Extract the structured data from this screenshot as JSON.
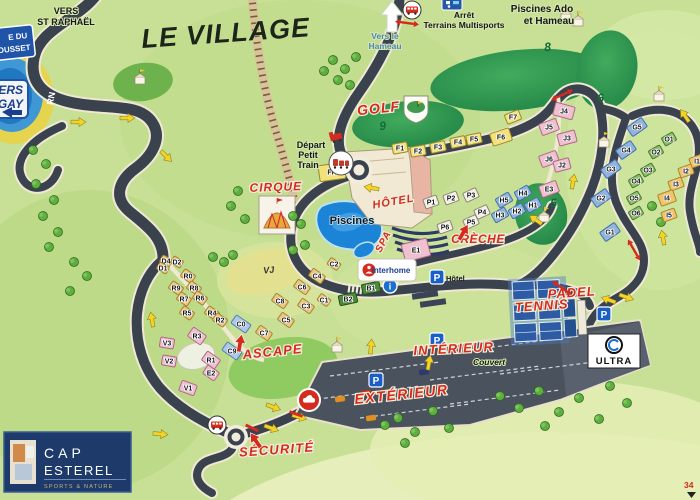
{
  "map_title": "LE VILLAGE",
  "signs": {
    "top_left_blue": {
      "line1": "E DU",
      "line2": "ROUSSET"
    },
    "vers_agay": {
      "line1": "ERS",
      "line2": "GAY"
    },
    "vers_st_raphael": {
      "line1": "VERS",
      "line2": "ST RAPHAËL"
    },
    "rn": "RN",
    "vers_le_hameau": {
      "line1": "Vers le",
      "line2": "Hameau"
    },
    "arret_multisports": {
      "line1": "Arrêt",
      "line2": "Terrains Multisports"
    },
    "piscines_ado": {
      "line1": "Piscines Ado",
      "line2": "et Hameau"
    },
    "depart_petit_train": {
      "line1": "Départ",
      "line2": "Petit",
      "line3": "Train"
    }
  },
  "labels": {
    "piscines": "Piscines",
    "hotel_parking": "Hôtel",
    "couvert": "Couvert",
    "vj": "VJ",
    "interhome": "interhome",
    "ultra": "ULTRA",
    "parking_p": "P",
    "info_i": "i",
    "corner_number": "34"
  },
  "logo": {
    "line1": "CAP",
    "line2": "ESTEREL",
    "tagline": "SPORTS & NATURE"
  },
  "zones": [
    {
      "text": "GOLF",
      "x": 379,
      "y": 113,
      "s": 14,
      "r": -6,
      "ls": 1
    },
    {
      "text": "CIRQUE",
      "x": 276,
      "y": 191,
      "s": 12,
      "r": -2,
      "ls": 1
    },
    {
      "text": "HÔTEL",
      "x": 394,
      "y": 205,
      "s": 11,
      "r": -10,
      "ls": 1
    },
    {
      "text": "SPA",
      "x": 386,
      "y": 243,
      "s": 10,
      "r": -62,
      "ls": 1
    },
    {
      "text": "CRÈCHE",
      "x": 478,
      "y": 243,
      "s": 12,
      "r": 0,
      "ls": 0.5
    },
    {
      "text": "PADEL",
      "x": 572,
      "y": 297,
      "s": 13,
      "r": -4,
      "ls": 1
    },
    {
      "text": "TENNIS",
      "x": 542,
      "y": 310,
      "s": 13,
      "r": -4,
      "ls": 1
    },
    {
      "text": "ASCAPE",
      "x": 273,
      "y": 356,
      "s": 13,
      "r": -6,
      "ls": 1
    },
    {
      "text": "INTÉRIEUR",
      "x": 454,
      "y": 353,
      "s": 13,
      "r": -3,
      "ls": 1.2
    },
    {
      "text": "EXTÉRIEUR",
      "x": 402,
      "y": 399,
      "s": 14,
      "r": -6,
      "ls": 1.6
    },
    {
      "text": "SÉCURITÉ",
      "x": 277,
      "y": 454,
      "s": 13,
      "r": -4,
      "ls": 1.2
    }
  ],
  "golf_holes": [
    {
      "n": "8",
      "x": 548,
      "y": 51
    },
    {
      "n": "9",
      "x": 383,
      "y": 130
    },
    {
      "n": "6",
      "x": 601,
      "y": 102
    },
    {
      "n": "5",
      "x": 554,
      "y": 207
    }
  ],
  "buildings": [
    {
      "l": "F1",
      "x": 400,
      "y": 148,
      "c": "yellow",
      "r": -10
    },
    {
      "l": "F2",
      "x": 418,
      "y": 151,
      "c": "yellow",
      "r": -10
    },
    {
      "l": "F3",
      "x": 438,
      "y": 147,
      "c": "yellow",
      "r": -12
    },
    {
      "l": "F4",
      "x": 458,
      "y": 142,
      "c": "yellow",
      "r": -12
    },
    {
      "l": "F5",
      "x": 474,
      "y": 139,
      "c": "yellow",
      "r": -12
    },
    {
      "l": "F6",
      "x": 501,
      "y": 137,
      "c": "yellow",
      "r": -18,
      "w": 20,
      "h": 13
    },
    {
      "l": "F7",
      "x": 513,
      "y": 117,
      "c": "yellow",
      "r": -22
    },
    {
      "l": "FH",
      "x": 332,
      "y": 172,
      "c": "yellow",
      "r": -8,
      "w": 26,
      "h": 16
    },
    {
      "l": "J4",
      "x": 564,
      "y": 111,
      "c": "pink",
      "r": 15,
      "w": 20,
      "h": 13
    },
    {
      "l": "J5",
      "x": 549,
      "y": 127,
      "c": "pink",
      "r": -20,
      "w": 18,
      "h": 12
    },
    {
      "l": "J3",
      "x": 567,
      "y": 138,
      "c": "pink",
      "r": -15,
      "w": 18,
      "h": 12
    },
    {
      "l": "J6",
      "x": 549,
      "y": 159,
      "c": "pink",
      "r": -20,
      "w": 18,
      "h": 12
    },
    {
      "l": "J2",
      "x": 562,
      "y": 165,
      "c": "pink",
      "r": -15,
      "w": 16,
      "h": 11
    },
    {
      "l": "E3",
      "x": 549,
      "y": 189,
      "c": "pink",
      "r": -20,
      "w": 18,
      "h": 12
    },
    {
      "l": "E1",
      "x": 416,
      "y": 250,
      "c": "pink",
      "r": -15,
      "w": 26,
      "h": 18
    },
    {
      "l": "G5",
      "x": 637,
      "y": 127,
      "c": "blue",
      "r": -35,
      "w": 18,
      "h": 11
    },
    {
      "l": "G4",
      "x": 626,
      "y": 150,
      "c": "blue",
      "r": -35,
      "w": 18,
      "h": 11
    },
    {
      "l": "G3",
      "x": 611,
      "y": 169,
      "c": "blue",
      "r": -35,
      "w": 18,
      "h": 11
    },
    {
      "l": "G2",
      "x": 601,
      "y": 198,
      "c": "blue",
      "r": -35,
      "w": 18,
      "h": 11
    },
    {
      "l": "G1",
      "x": 610,
      "y": 232,
      "c": "blue",
      "r": -35,
      "w": 18,
      "h": 11
    },
    {
      "l": "O1",
      "x": 669,
      "y": 139,
      "c": "green",
      "r": -30,
      "w": 13,
      "h": 9
    },
    {
      "l": "O2",
      "x": 656,
      "y": 152,
      "c": "green",
      "r": -30,
      "w": 13,
      "h": 9
    },
    {
      "l": "O3",
      "x": 648,
      "y": 170,
      "c": "green",
      "r": -30,
      "w": 13,
      "h": 9
    },
    {
      "l": "O4",
      "x": 636,
      "y": 181,
      "c": "green",
      "r": -30,
      "w": 13,
      "h": 9
    },
    {
      "l": "O5",
      "x": 634,
      "y": 198,
      "c": "green",
      "r": -30,
      "w": 13,
      "h": 9
    },
    {
      "l": "O6",
      "x": 636,
      "y": 213,
      "c": "green",
      "r": -30,
      "w": 13,
      "h": 9
    },
    {
      "l": "I1",
      "x": 697,
      "y": 161,
      "c": "orange",
      "r": -20,
      "w": 14,
      "h": 10
    },
    {
      "l": "I2",
      "x": 686,
      "y": 171,
      "c": "orange",
      "r": -20,
      "w": 14,
      "h": 10
    },
    {
      "l": "I3",
      "x": 676,
      "y": 184,
      "c": "orange",
      "r": -20,
      "w": 14,
      "h": 10
    },
    {
      "l": "I4",
      "x": 667,
      "y": 198,
      "c": "orange",
      "r": -20,
      "w": 16,
      "h": 12
    },
    {
      "l": "I5",
      "x": 669,
      "y": 215,
      "c": "orange",
      "r": -20,
      "w": 14,
      "h": 10
    },
    {
      "l": "H5",
      "x": 504,
      "y": 200,
      "c": "blue",
      "r": -30,
      "w": 15,
      "h": 10
    },
    {
      "l": "H4",
      "x": 523,
      "y": 193,
      "c": "blue",
      "r": -30,
      "w": 15,
      "h": 10
    },
    {
      "l": "H3",
      "x": 500,
      "y": 215,
      "c": "blue",
      "r": -30,
      "w": 15,
      "h": 10
    },
    {
      "l": "H2",
      "x": 517,
      "y": 211,
      "c": "blue",
      "r": -30,
      "w": 15,
      "h": 10
    },
    {
      "l": "H1",
      "x": 533,
      "y": 205,
      "c": "blue",
      "r": -30,
      "w": 15,
      "h": 10
    },
    {
      "l": "P1",
      "x": 431,
      "y": 202,
      "c": "white",
      "r": -20,
      "w": 14,
      "h": 10
    },
    {
      "l": "P2",
      "x": 451,
      "y": 198,
      "c": "white",
      "r": -20,
      "w": 14,
      "h": 10
    },
    {
      "l": "P3",
      "x": 471,
      "y": 195,
      "c": "white",
      "r": -25,
      "w": 14,
      "h": 10
    },
    {
      "l": "P4",
      "x": 482,
      "y": 212,
      "c": "white",
      "r": -25,
      "w": 14,
      "h": 10
    },
    {
      "l": "P5",
      "x": 471,
      "y": 222,
      "c": "white",
      "r": -25,
      "w": 14,
      "h": 10
    },
    {
      "l": "P6",
      "x": 445,
      "y": 227,
      "c": "white",
      "r": -20,
      "w": 14,
      "h": 10
    },
    {
      "l": "R0",
      "x": 188,
      "y": 276,
      "c": "tan",
      "r": 35,
      "w": 13,
      "h": 9
    },
    {
      "l": "R9",
      "x": 176,
      "y": 288,
      "c": "tan",
      "r": 35,
      "w": 13,
      "h": 9
    },
    {
      "l": "R8",
      "x": 194,
      "y": 288,
      "c": "tan",
      "r": 35,
      "w": 13,
      "h": 9
    },
    {
      "l": "R7",
      "x": 184,
      "y": 299,
      "c": "tan",
      "r": 35,
      "w": 13,
      "h": 9
    },
    {
      "l": "R6",
      "x": 200,
      "y": 298,
      "c": "tan",
      "r": 35,
      "w": 13,
      "h": 9
    },
    {
      "l": "R5",
      "x": 187,
      "y": 313,
      "c": "tan",
      "r": 35,
      "w": 13,
      "h": 9
    },
    {
      "l": "R4",
      "x": 212,
      "y": 313,
      "c": "tan",
      "r": 35,
      "w": 13,
      "h": 9
    },
    {
      "l": "R2",
      "x": 220,
      "y": 320,
      "c": "tan",
      "r": 35,
      "w": 13,
      "h": 9
    },
    {
      "l": "D4",
      "x": 166,
      "y": 261,
      "c": "tan",
      "r": 30,
      "w": 11,
      "h": 8
    },
    {
      "l": "D2",
      "x": 177,
      "y": 262,
      "c": "tan",
      "r": 30,
      "w": 11,
      "h": 8
    },
    {
      "l": "D1",
      "x": 163,
      "y": 268,
      "c": "tan",
      "r": 30,
      "w": 11,
      "h": 8
    },
    {
      "l": "R3",
      "x": 197,
      "y": 336,
      "c": "pink",
      "r": 35,
      "w": 16,
      "h": 11
    },
    {
      "l": "R1",
      "x": 211,
      "y": 360,
      "c": "pink",
      "r": 35,
      "w": 16,
      "h": 11
    },
    {
      "l": "E2",
      "x": 211,
      "y": 373,
      "c": "pink",
      "r": 35,
      "w": 14,
      "h": 10
    },
    {
      "l": "V1",
      "x": 188,
      "y": 388,
      "c": "pink",
      "r": 20,
      "w": 16,
      "h": 11
    },
    {
      "l": "V2",
      "x": 169,
      "y": 361,
      "c": "pink",
      "r": 10,
      "w": 14,
      "h": 10
    },
    {
      "l": "V3",
      "x": 167,
      "y": 343,
      "c": "pink",
      "r": 10,
      "w": 14,
      "h": 10
    },
    {
      "l": "C4",
      "x": 317,
      "y": 276,
      "c": "tan",
      "r": 35,
      "w": 15,
      "h": 9
    },
    {
      "l": "C6",
      "x": 302,
      "y": 287,
      "c": "tan",
      "r": 35,
      "w": 15,
      "h": 9
    },
    {
      "l": "C8",
      "x": 280,
      "y": 301,
      "c": "tan",
      "r": 35,
      "w": 15,
      "h": 9
    },
    {
      "l": "C3",
      "x": 306,
      "y": 306,
      "c": "tan",
      "r": 35,
      "w": 15,
      "h": 9
    },
    {
      "l": "C5",
      "x": 286,
      "y": 320,
      "c": "tan",
      "r": 35,
      "w": 15,
      "h": 9
    },
    {
      "l": "C7",
      "x": 264,
      "y": 333,
      "c": "tan",
      "r": 35,
      "w": 15,
      "h": 9
    },
    {
      "l": "C1",
      "x": 324,
      "y": 300,
      "c": "tan",
      "r": 35,
      "w": 12,
      "h": 8
    },
    {
      "l": "C2",
      "x": 334,
      "y": 264,
      "c": "tan",
      "r": 35,
      "w": 12,
      "h": 8
    },
    {
      "l": "C0",
      "x": 241,
      "y": 324,
      "c": "lightblue",
      "r": 35,
      "w": 18,
      "h": 10
    },
    {
      "l": "C9",
      "x": 232,
      "y": 351,
      "c": "lightblue",
      "r": 35,
      "w": 18,
      "h": 10
    },
    {
      "l": "B1",
      "x": 371,
      "y": 288,
      "c": "darkgreen",
      "r": -12,
      "w": 18,
      "h": 10
    },
    {
      "l": "B2",
      "x": 348,
      "y": 299,
      "c": "darkgreen",
      "r": -12,
      "w": 18,
      "h": 10
    }
  ],
  "palette": {
    "yellow": {
      "f": "#f3e27a",
      "s": "#9a8a30"
    },
    "pink": {
      "f": "#efc0cf",
      "s": "#b06a85"
    },
    "blue": {
      "f": "#8fb4e0",
      "s": "#4a6fa8"
    },
    "green": {
      "f": "#8cc061",
      "s": "#4a7a32"
    },
    "darkgreen": {
      "f": "#4e8a3c",
      "s": "#27511d"
    },
    "orange": {
      "f": "#f0c468",
      "s": "#a8842e"
    },
    "tan": {
      "f": "#e9c77e",
      "s": "#a8842e"
    },
    "white": {
      "f": "#f4efdf",
      "s": "#8a8578"
    },
    "lightblue": {
      "f": "#aac8e8",
      "s": "#5a7fb0"
    }
  },
  "colors": {
    "red_label": "#d42b1e",
    "road": "#3a424d",
    "road_casing": "#efe8d4",
    "pool_blue": "#1b84d6",
    "golf_green_dark": "#248747",
    "parking": "#4a525e",
    "logo_navy": "#1d3a6b",
    "parking_icon_blue": "#1a5fc8"
  },
  "yellow_arrows": [
    {
      "x": 78,
      "y": 122,
      "r": 0
    },
    {
      "x": 127,
      "y": 118,
      "r": 0
    },
    {
      "x": 166,
      "y": 156,
      "r": 45
    },
    {
      "x": 152,
      "y": 320,
      "r": 260
    },
    {
      "x": 372,
      "y": 188,
      "r": 190
    },
    {
      "x": 536,
      "y": 220,
      "r": 215
    },
    {
      "x": 573,
      "y": 182,
      "r": 280
    },
    {
      "x": 685,
      "y": 116,
      "r": 235
    },
    {
      "x": 663,
      "y": 238,
      "r": 260
    },
    {
      "x": 609,
      "y": 300,
      "r": 200
    },
    {
      "x": 626,
      "y": 297,
      "r": 20
    },
    {
      "x": 371,
      "y": 347,
      "r": 275
    },
    {
      "x": 429,
      "y": 363,
      "r": 280
    },
    {
      "x": 273,
      "y": 407,
      "r": 20
    },
    {
      "x": 299,
      "y": 417,
      "r": 15
    },
    {
      "x": 271,
      "y": 428,
      "r": 20
    },
    {
      "x": 160,
      "y": 434,
      "r": 5
    }
  ],
  "red_up_arrows": [
    {
      "x": 463,
      "y": 233,
      "r": 30
    },
    {
      "x": 240,
      "y": 344,
      "r": 10
    },
    {
      "x": 256,
      "y": 441,
      "r": -35
    }
  ],
  "red_cross_arrows": [
    {
      "x": 407,
      "y": 23,
      "r": 8
    },
    {
      "x": 562,
      "y": 288,
      "r": 35
    },
    {
      "x": 634,
      "y": 250,
      "r": 60
    },
    {
      "x": 562,
      "y": 95,
      "r": -25
    }
  ],
  "trees": [
    {
      "x": 333,
      "y": 60
    },
    {
      "x": 345,
      "y": 69
    },
    {
      "x": 356,
      "y": 57
    },
    {
      "x": 324,
      "y": 71
    },
    {
      "x": 338,
      "y": 80
    },
    {
      "x": 350,
      "y": 85
    },
    {
      "x": 33,
      "y": 150
    },
    {
      "x": 46,
      "y": 164
    },
    {
      "x": 36,
      "y": 184
    },
    {
      "x": 54,
      "y": 200
    },
    {
      "x": 43,
      "y": 216
    },
    {
      "x": 58,
      "y": 232
    },
    {
      "x": 49,
      "y": 247
    },
    {
      "x": 74,
      "y": 262
    },
    {
      "x": 87,
      "y": 276
    },
    {
      "x": 70,
      "y": 291
    },
    {
      "x": 238,
      "y": 191
    },
    {
      "x": 231,
      "y": 206
    },
    {
      "x": 245,
      "y": 219
    },
    {
      "x": 213,
      "y": 257
    },
    {
      "x": 224,
      "y": 262
    },
    {
      "x": 233,
      "y": 255
    },
    {
      "x": 293,
      "y": 250
    },
    {
      "x": 305,
      "y": 245
    },
    {
      "x": 293,
      "y": 216
    },
    {
      "x": 301,
      "y": 224
    },
    {
      "x": 398,
      "y": 418
    },
    {
      "x": 415,
      "y": 432
    },
    {
      "x": 433,
      "y": 411
    },
    {
      "x": 449,
      "y": 428
    },
    {
      "x": 405,
      "y": 443
    },
    {
      "x": 385,
      "y": 425
    },
    {
      "x": 500,
      "y": 396
    },
    {
      "x": 519,
      "y": 408
    },
    {
      "x": 539,
      "y": 391
    },
    {
      "x": 559,
      "y": 412
    },
    {
      "x": 579,
      "y": 398
    },
    {
      "x": 599,
      "y": 419
    },
    {
      "x": 545,
      "y": 426
    },
    {
      "x": 610,
      "y": 386
    },
    {
      "x": 627,
      "y": 403
    },
    {
      "x": 652,
      "y": 206
    },
    {
      "x": 661,
      "y": 222
    }
  ],
  "huts": [
    {
      "x": 140,
      "y": 80
    },
    {
      "x": 604,
      "y": 143
    },
    {
      "x": 659,
      "y": 97
    },
    {
      "x": 544,
      "y": 218
    },
    {
      "x": 566,
      "y": 17
    },
    {
      "x": 578,
      "y": 22
    },
    {
      "x": 337,
      "y": 348
    }
  ],
  "parking_icons": [
    {
      "x": 437,
      "y": 277,
      "label": "Hôtel"
    },
    {
      "x": 376,
      "y": 380
    },
    {
      "x": 437,
      "y": 340
    },
    {
      "x": 604,
      "y": 314
    }
  ]
}
